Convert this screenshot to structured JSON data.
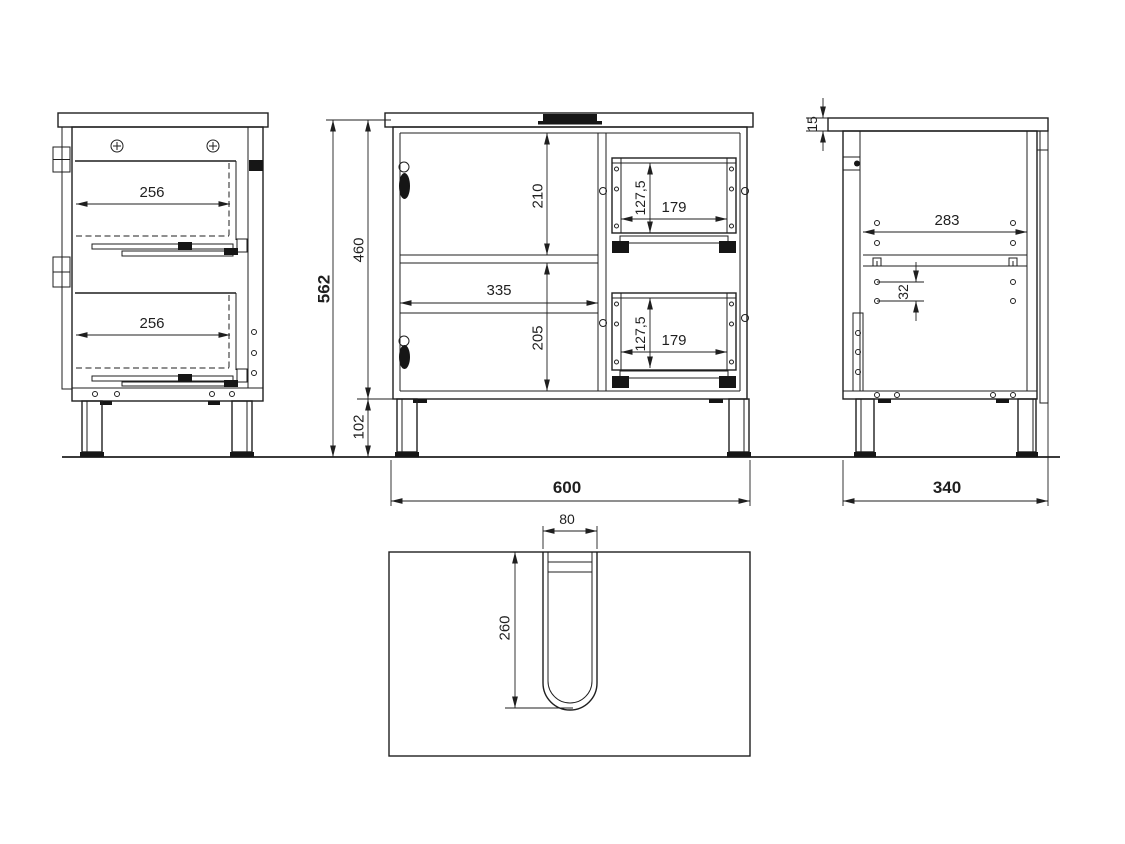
{
  "title": "Vanity cabinet technical drawing",
  "colors": {
    "line": "#1f1f1f",
    "background": "#ffffff"
  },
  "views": {
    "left_side": {
      "label": "left side view",
      "dims": {
        "drawer_depth_top": "256",
        "drawer_depth_bottom": "256"
      }
    },
    "overall": {
      "dims": {
        "total_height": "562",
        "carcass_height": "460",
        "leg_height": "102"
      }
    },
    "front": {
      "label": "front view",
      "dims": {
        "upper_compartment_height": "210",
        "compartment_width": "335",
        "lower_compartment_height": "205",
        "upper_drawer_height": "127,5",
        "upper_drawer_width": "179",
        "lower_drawer_height": "127,5",
        "lower_drawer_width": "179",
        "overall_width": "600"
      }
    },
    "right_side": {
      "label": "right side view",
      "dims": {
        "top_panel_thickness": "15",
        "pin_hole_span": "283",
        "pin_hole_pitch": "32",
        "overall_depth": "340"
      }
    },
    "top": {
      "label": "top view",
      "dims": {
        "cutout_width": "80",
        "cutout_depth": "260"
      }
    }
  }
}
